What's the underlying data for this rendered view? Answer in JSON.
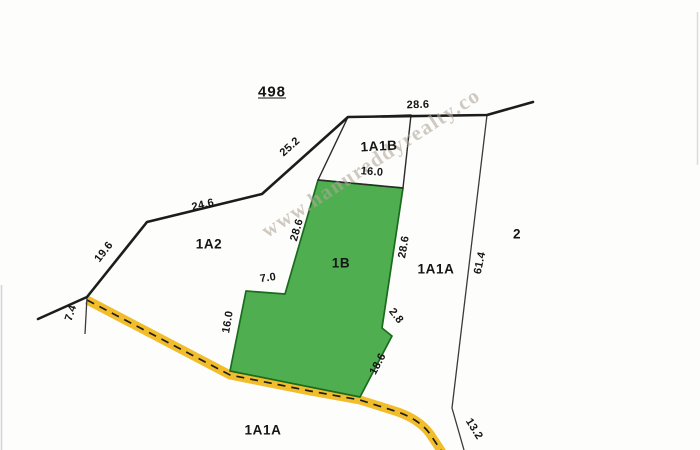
{
  "header": {
    "survey_number": "498"
  },
  "watermark": {
    "text": "www.hanureddyrealty.co"
  },
  "parcel_labels": {
    "a1a2": "1A2",
    "a1b": "1B",
    "a1a1b": "1A1B",
    "a1a1a_east": "1A1A",
    "a1a1a_south": "1A1A",
    "a2": "2"
  },
  "dimension_labels": {
    "seg_25_2": "25.2",
    "seg_24_6": "24.6",
    "seg_19_6": "19.6",
    "seg_7_4": "7.4",
    "seg_28_6_top": "28.6",
    "seg_16_0_top": "16.0",
    "seg_28_6_west": "28.6",
    "seg_7_0": "7.0",
    "seg_16_0_west": "16.0",
    "seg_28_6_east": "28.6",
    "seg_2_8": "2.8",
    "seg_18_6": "18.6",
    "seg_61_4": "61.4",
    "seg_13_2": "13.2"
  },
  "colors": {
    "plot_green_fill": "#4fae50",
    "plot_green_border": "#1a6b1e",
    "road_yellow": "#f2bd2a",
    "road_dash_black": "#1d1d1d",
    "boundary_black": "#1c1c1c",
    "thin_line_gray": "#3a3a3a",
    "watermark_gray": "#b0a89a"
  }
}
